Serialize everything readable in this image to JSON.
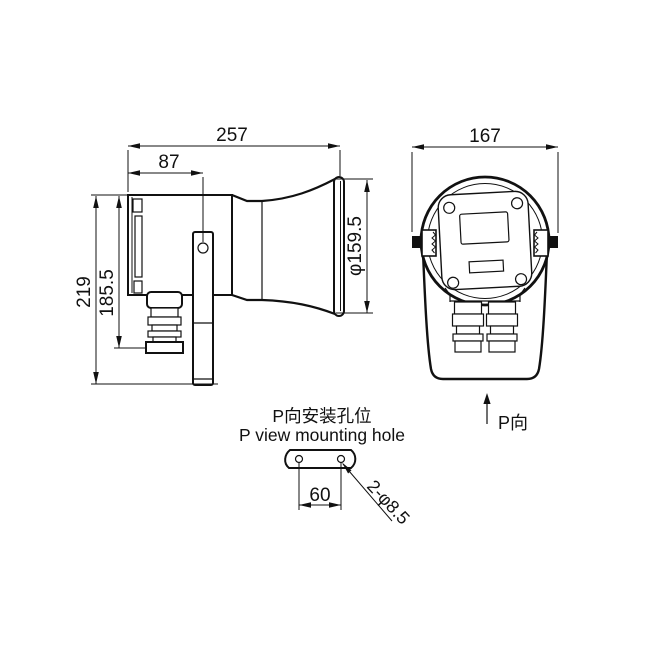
{
  "drawing": {
    "side_view": {
      "dims": {
        "overall_length": "257",
        "bracket_offset": "87",
        "overall_height": "219",
        "body_height": "185.5",
        "horn_diameter": "φ159.5"
      }
    },
    "front_view": {
      "dims": {
        "overall_width": "167"
      },
      "view_label": "P向"
    },
    "mounting_detail": {
      "title_zh": "P向安装孔位",
      "title_en": "P view mounting hole",
      "dims": {
        "hole_spacing": "60",
        "hole_spec": "2-φ8.5"
      }
    },
    "colors": {
      "line": "#111111",
      "background": "#ffffff"
    }
  }
}
